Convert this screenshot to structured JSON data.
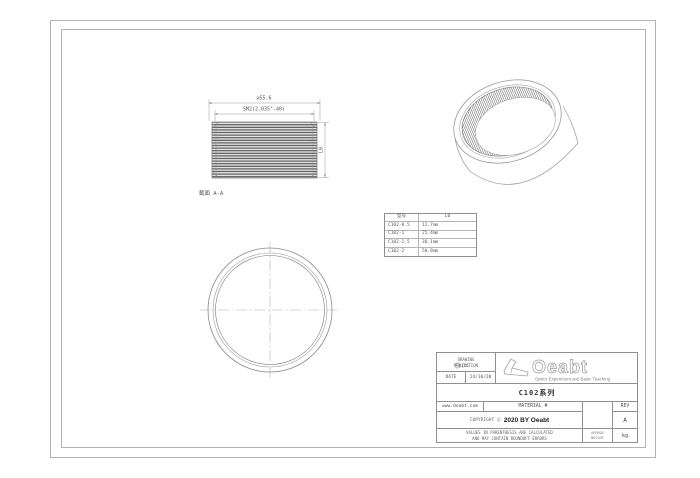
{
  "colors": {
    "line": "#9a9a9a",
    "text": "#555555",
    "thread_dark": "#4f4f4f"
  },
  "views": {
    "side": {
      "dim_outer": "∅55.6",
      "dim_thread": "SM2(2.035\"-40)",
      "dim_height": "L0",
      "section_label": "截面 A-A"
    }
  },
  "table": {
    "headers": [
      "型号",
      "L0"
    ],
    "rows": [
      [
        "C102-0.5",
        "12.7mm"
      ],
      [
        "C102-1",
        "25.4mm"
      ],
      [
        "C102-1.5",
        "38.1mm"
      ],
      [
        "C102-2",
        "50.8mm"
      ]
    ]
  },
  "title_block": {
    "projection_line1": "DRAWING",
    "projection_line2": "PROJECTION",
    "date_label": "DATE",
    "date_value": "14/10/20",
    "logo_text": "Oeabt",
    "logo_tagline": "Optics Experiment and Basic Teaching",
    "series": "C102系列",
    "website": "www.Oeabt.com",
    "material": "MATERIAL #",
    "rev_label": "REV",
    "rev_value": "A",
    "copyright_label": "COPYRIGHT",
    "copyright_symbol": "©",
    "copyright_text": "2020 BY Oeabt",
    "disclaimer1": "VALUES IN PARENTHESIS ARE CALCULATED",
    "disclaimer2": "AND MAY CONTAIN ROUNDOFF ERRORS",
    "approx1": "APPROX",
    "approx2": "WEIGHT",
    "unit": "kg"
  }
}
